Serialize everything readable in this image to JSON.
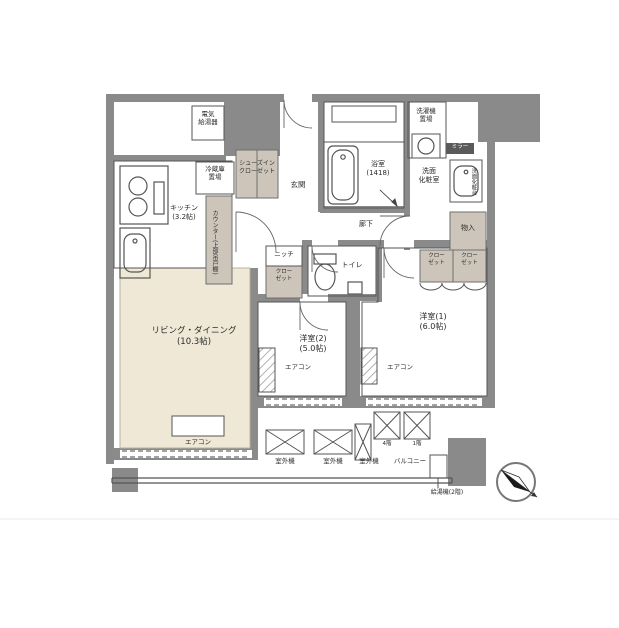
{
  "rooms": {
    "living_dining": {
      "name": "リビング・ダイニング",
      "size": "(10.3帖)"
    },
    "kitchen": {
      "name": "キッチン",
      "size": "(3.2帖)"
    },
    "western1": {
      "name": "洋室(1)",
      "size": "(6.0帖)"
    },
    "western2": {
      "name": "洋室(2)",
      "size": "(5.0帖)"
    },
    "bath": {
      "name": "浴室",
      "size": "(1418)"
    },
    "washroom": {
      "line1": "洗面",
      "line2": "化粧室"
    },
    "toilet": "トイレ",
    "entrance": "玄関",
    "hallway": "廊下",
    "balcony": "バルコニー"
  },
  "storage": {
    "shoes_in_closet": {
      "line1": "シューズイン",
      "line2": "クローゼット"
    },
    "closet": {
      "line1": "クロー",
      "line2": "ゼット"
    },
    "storage_compartment": "物入",
    "niche": "ニッチ"
  },
  "equipment": {
    "electric_water_heater": {
      "line1": "電気",
      "line2": "給湯器"
    },
    "refrigerator_space": {
      "line1": "冷蔵庫",
      "line2": "置場"
    },
    "washer_space": {
      "line1": "洗濯機",
      "line2": "置場"
    },
    "counter": "カウンター(上部吊戸棚)",
    "vanity": "洗面化粧台",
    "mirror": "ミラー",
    "air_conditioner": "エアコン",
    "outdoor_unit": "室外機",
    "unit_floor4": "4階",
    "unit_floor1": "1階",
    "water_heater_2f": "給湯機(2階)"
  },
  "colors": {
    "wall": "#8a8a8a",
    "ld_floor": "#efe8d6",
    "storage_fill": "#cdc5ba",
    "line": "#555555"
  }
}
